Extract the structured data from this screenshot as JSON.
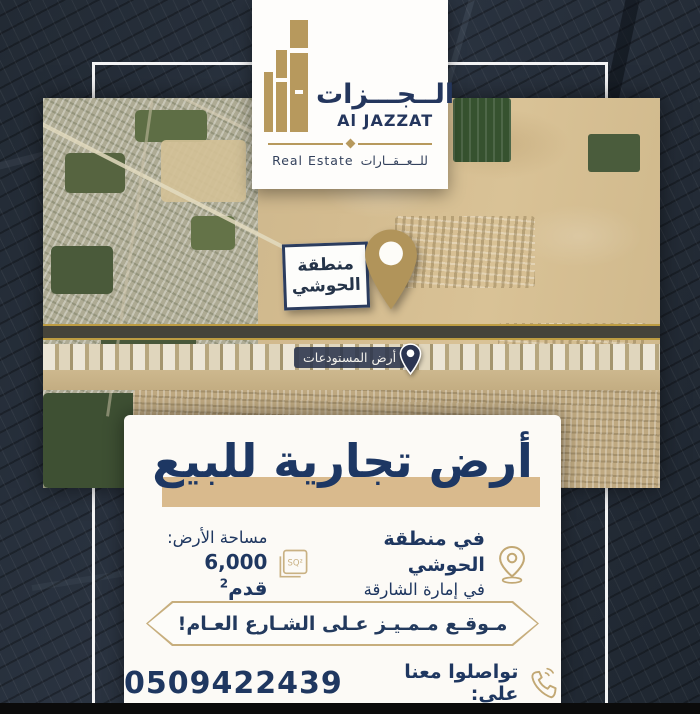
{
  "brand": {
    "name_ar": "الــجـــزات",
    "name_en": "Al JAZZAT",
    "tagline_en": "Real Estate",
    "tagline_ar": "للــعــقــارات"
  },
  "map_labels": {
    "area_pin_line1": "منطقة",
    "area_pin_line2": "الحوشي",
    "road_label": "أرض المستودعات"
  },
  "ad": {
    "headline": "أرض تجارية للبيع",
    "location_line1": "في منطقة الحوشي",
    "location_line2": "في إمارة الشارقة",
    "area_label": "مساحة الأرض:",
    "area_value": "6,000 قدم",
    "area_unit_sup": "2",
    "sq_icon_text": "SQ²",
    "banner": "مـوقـع مـمـيـز عـلى الشـارع العـام!",
    "contact_label": "تواصلوا معنا على:",
    "phone": "0509422439"
  },
  "colors": {
    "navy": "#1f3760",
    "gold": "#b5985c",
    "tan_highlight": "#d9ba8d",
    "card_bg": "#fcfaf6",
    "pill_border": "#c7ae7d"
  }
}
